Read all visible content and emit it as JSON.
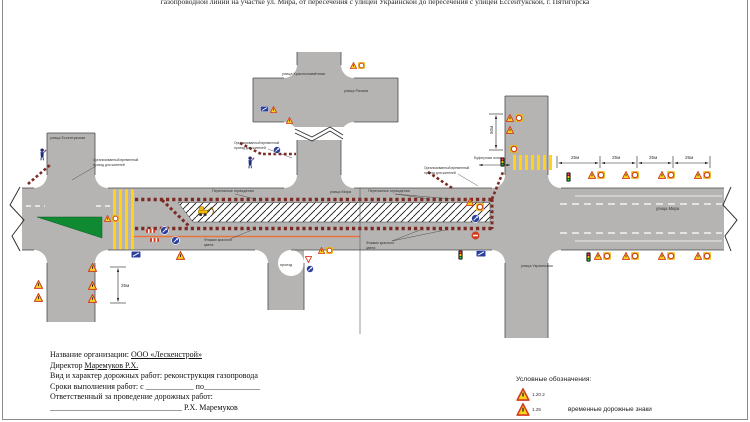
{
  "title": "газопроводной линии на участке ул. Мира, от пересечения с улицей Украинской до пересечения с улицей Ессентукской, г. Пятигорска",
  "streets": {
    "essentukskaya": "улица Ессентукская",
    "krasnoznamennaya": "улица Краснознамённая",
    "razina": "улица Разина",
    "mira": "улица Мира",
    "ukrainskaya": "улица Украинская",
    "proezd": "проезд"
  },
  "annotations": {
    "fences": "Переносные ограждения",
    "flags_line1": "Флажки красного",
    "flags_line2": "цвета",
    "passage_line1": "Организованный временный",
    "passage_line2": "проезд для жителей"
  },
  "dimensions": {
    "d25": "25м",
    "d50": "50м",
    "buffer": "Буферная зона"
  },
  "legend": {
    "title": "Условные обозначения:",
    "sign1": "1.20.2",
    "sign2": "1.25",
    "caption": "временные дорожные знаки"
  },
  "info": {
    "l1_label": "Название организации: ",
    "l1_value": "ООО «Лескенстрой»",
    "l2_label": "Директор ",
    "l2_value": "Маремуков Р.Х.",
    "l3": "Вид и характер дорожных работ: реконструкция газопровода",
    "l4": "Сроки выполнения работ: с ____________ по______________",
    "l5": "Ответственный за проведение дорожных работ:",
    "l6_line": "_________________________________",
    "l6_name": "Р.Х. Маремуков"
  },
  "icons": {
    "warning-triangle-icon": "▲",
    "speed-sign-icon": "◯",
    "detour-sign-icon": "●",
    "no-entry-icon": "⛔",
    "give-way-icon": "▽",
    "info-sign-icon": "▦",
    "traffic-light-icon": "🚦",
    "flagman-icon": "⚑",
    "excavator-icon": "⛏",
    "barrier-fence-icon": "▬"
  },
  "colors": {
    "road": "#b5b4b2",
    "barrier": "#7c2a24",
    "taper_green": "#0f8a33",
    "crosswalk_yellow": "#ffd21e",
    "temp_path_orange": "#e8743b",
    "sign_yellow": "#ffd21e",
    "sign_red": "#d23b1e",
    "sign_blue": "#2b3f9e"
  }
}
